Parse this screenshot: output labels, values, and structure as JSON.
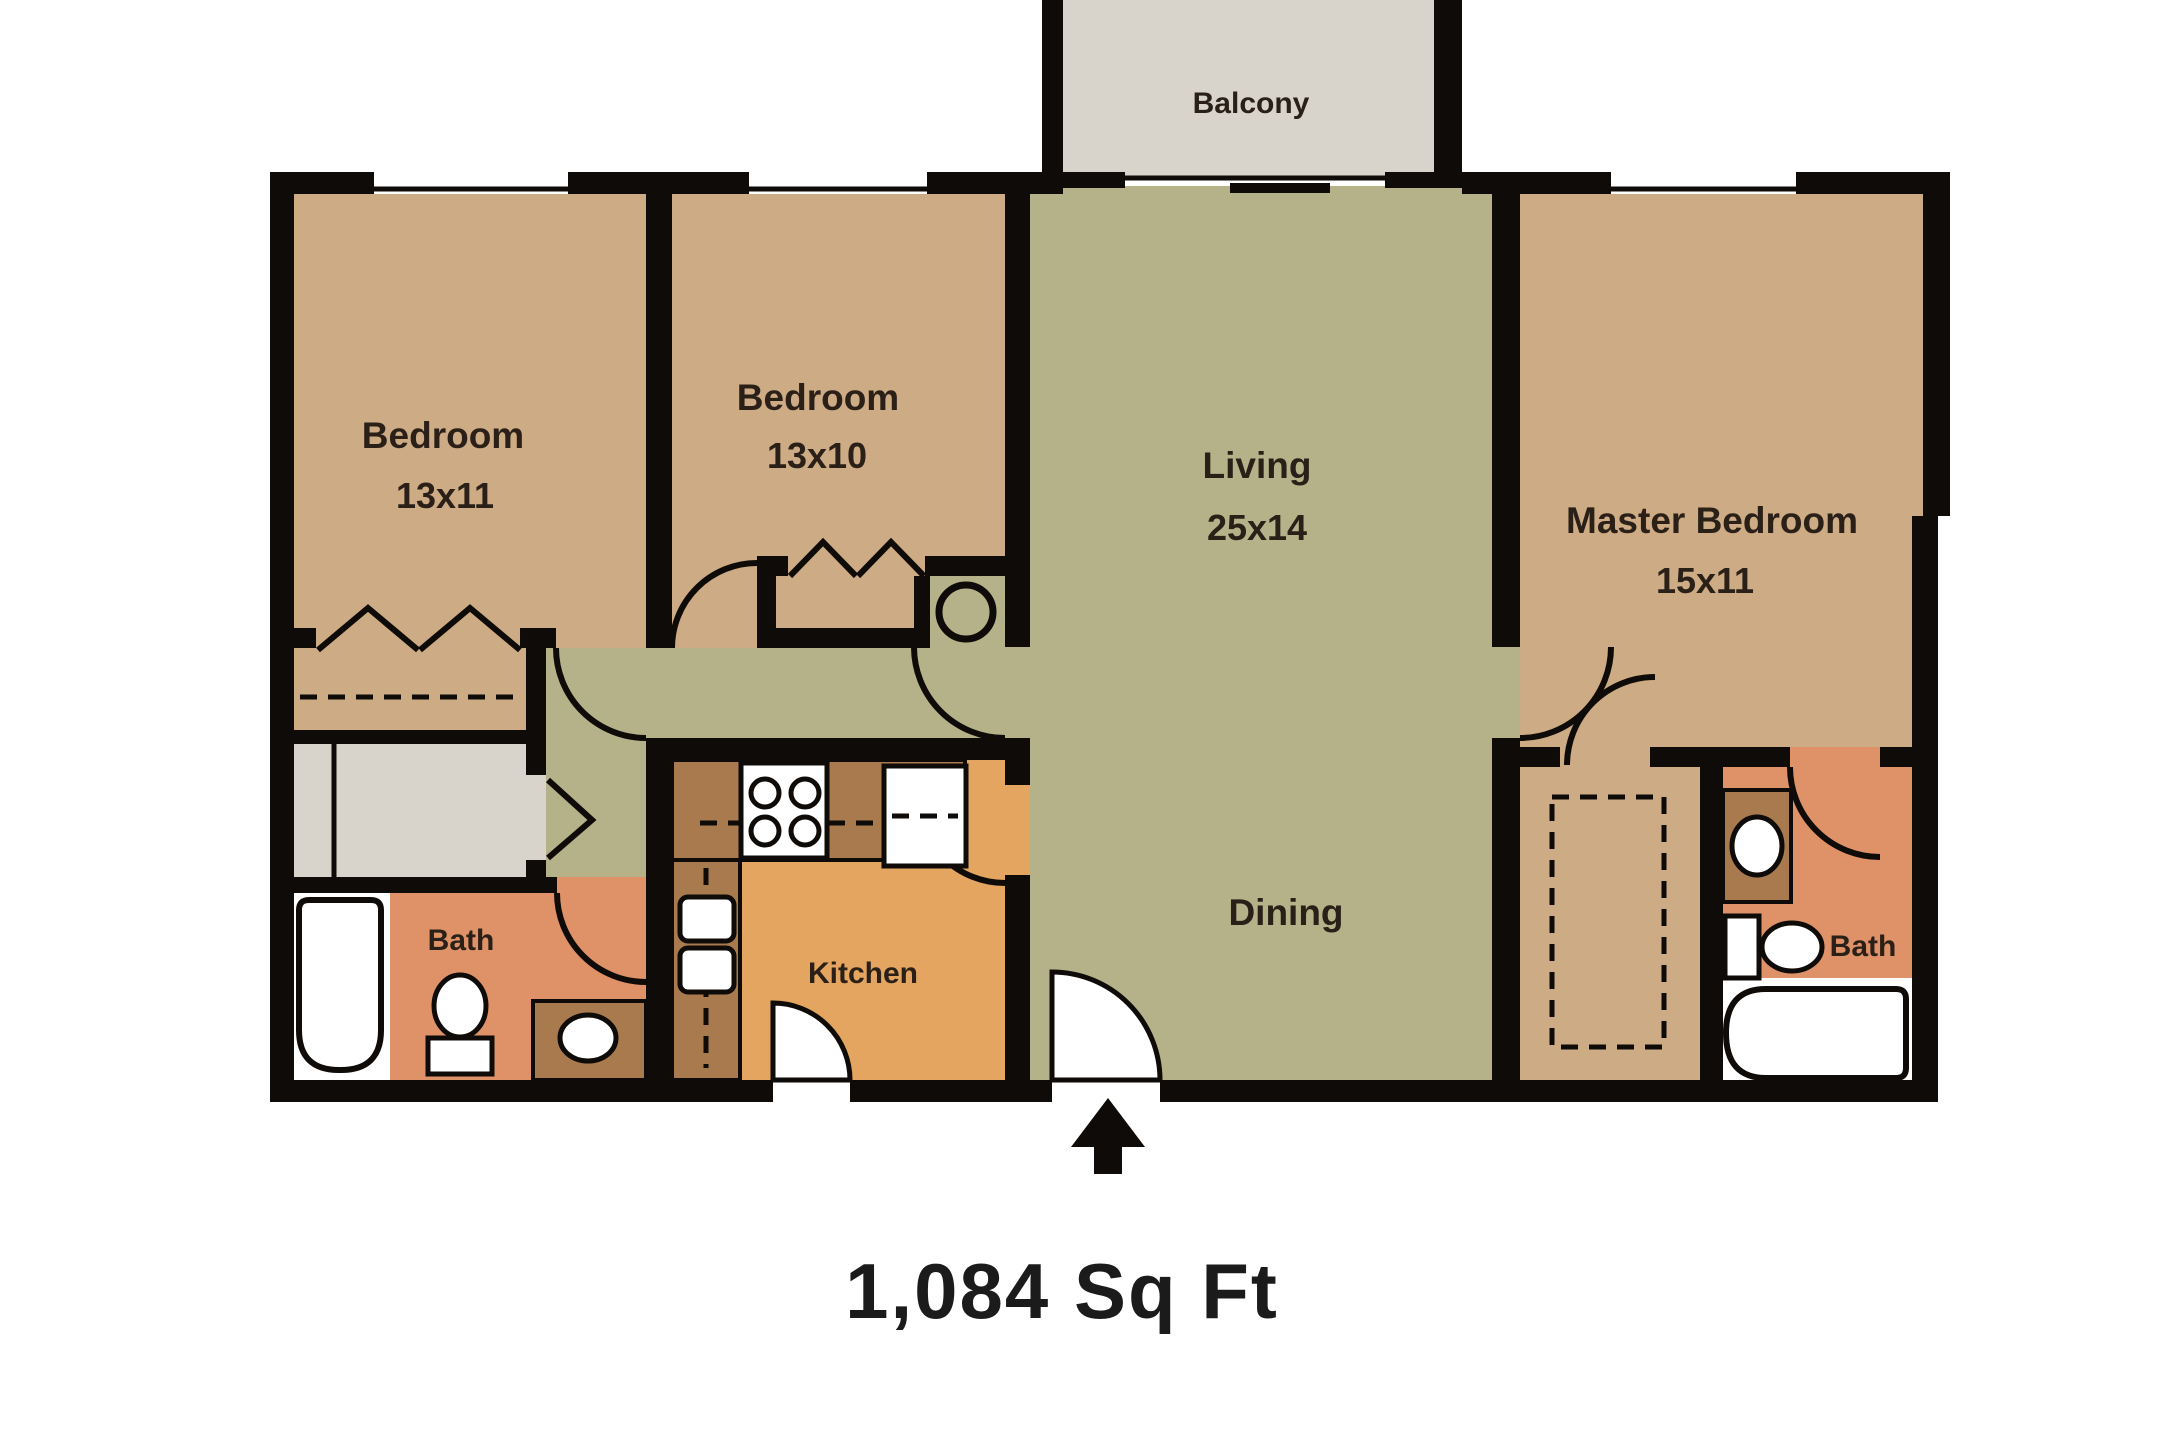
{
  "plan": {
    "title": "Floor plan",
    "total_area": "1,084 Sq Ft",
    "rooms": {
      "balcony": {
        "label": "Balcony",
        "dimensions": ""
      },
      "bedroom1": {
        "label": "Bedroom",
        "dimensions": "13x11"
      },
      "bedroom2": {
        "label": "Bedroom",
        "dimensions": "13x10"
      },
      "living": {
        "label": "Living",
        "dimensions": "25x14"
      },
      "master": {
        "label": "Master Bedroom",
        "dimensions": "15x11"
      },
      "dining": {
        "label": "Dining",
        "dimensions": ""
      },
      "kitchen": {
        "label": "Kitchen",
        "dimensions": ""
      },
      "bath1": {
        "label": "Bath",
        "dimensions": ""
      },
      "bath2": {
        "label": "Bath",
        "dimensions": ""
      }
    },
    "fixtures": [
      "bathtub",
      "toilet",
      "vanity-sink",
      "double-kitchen-sink",
      "stove-4-burner",
      "refrigerator",
      "water-heater",
      "walk-in-closet",
      "bifold-closet-doors",
      "entry-door"
    ],
    "colors": {
      "bg": "#ffffff",
      "wall": "#0e0b08",
      "floor_tan": "#cdab84",
      "floor_green": "#b5b28a",
      "floor_gray": "#d8d4cc",
      "floor_salmon": "#df9268",
      "floor_orange": "#e3a55f",
      "counter_brown": "#a87a4e",
      "label": "#2b2018",
      "text_dark": "#1b1b1b"
    }
  }
}
